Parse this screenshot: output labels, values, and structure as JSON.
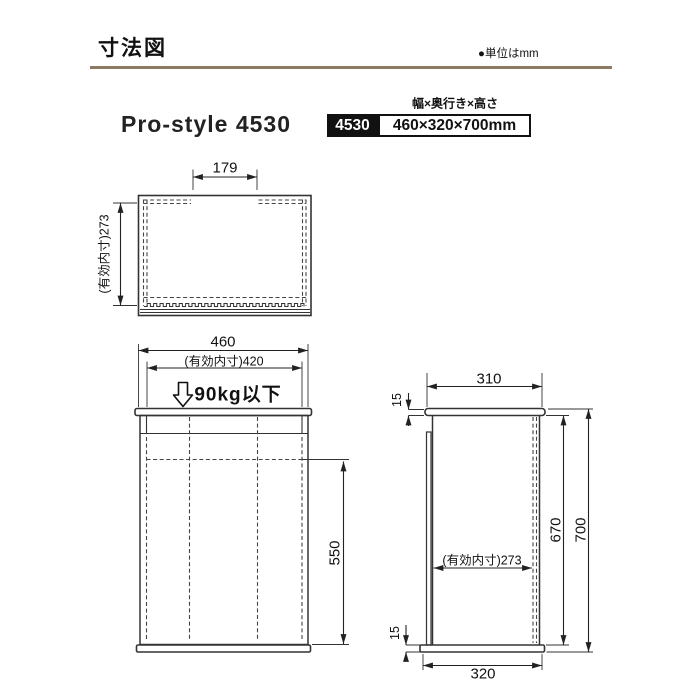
{
  "header": {
    "title": "寸法図",
    "unit_note": "●単位はmm"
  },
  "product": {
    "name": "Pro-style 4530",
    "spec_header": "幅×奥行き×高さ",
    "model": "4530",
    "size": "460×320×700mm"
  },
  "top_view": {
    "opening_width_label": "179",
    "inner_depth_label": "(有効内寸)273"
  },
  "front_view": {
    "width_label": "460",
    "inner_width_label": "(有効内寸)420",
    "load_label": "90kg以下",
    "inner_height_label": "550"
  },
  "side_view": {
    "top_width_label": "310",
    "top_thickness_label": "15",
    "inner_depth_label": "(有効内寸)273",
    "body_height_label": "670",
    "total_height_label": "700",
    "base_thickness_label": "15",
    "base_width_label": "320"
  },
  "colors": {
    "accent_rule": "#8c7b62",
    "badge_bg": "#111111",
    "line": "#333333"
  }
}
